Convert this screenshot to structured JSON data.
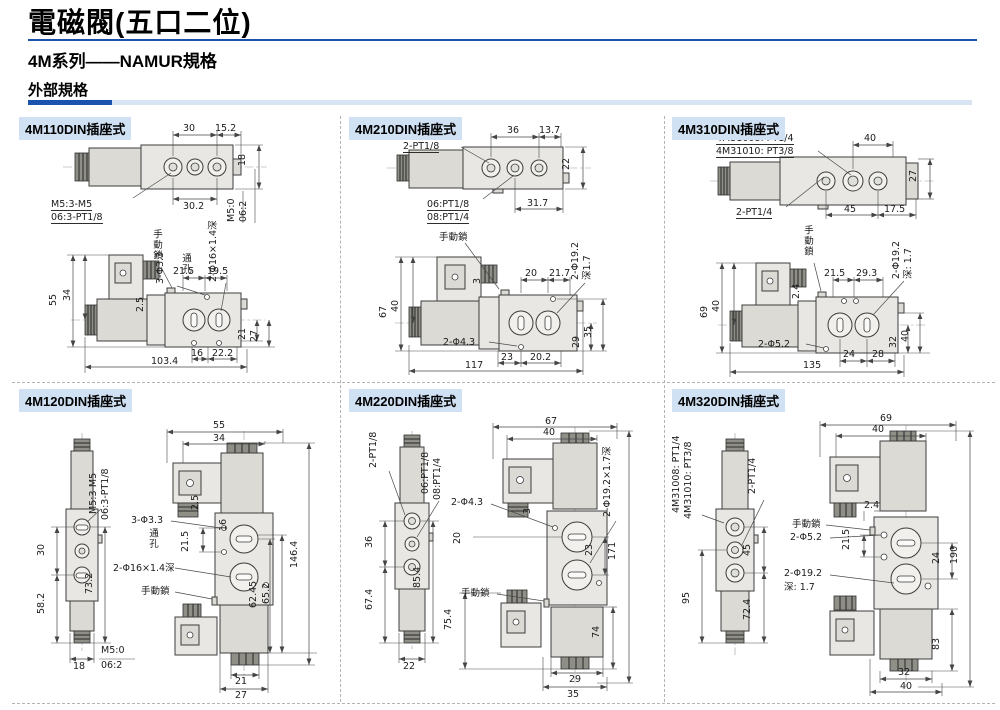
{
  "header": {
    "title": "電磁閥(五口二位)",
    "subtitle": "4M系列——NAMUR規格",
    "section": "外部規格"
  },
  "colors": {
    "accent": "#1b52ad",
    "bar_light": "#d9e4f2",
    "panel_title_bg": "#cfe1f3"
  },
  "panels": [
    {
      "title": "4M110DIN插座式",
      "d": {
        "w30": "30",
        "w152": "15.2",
        "h18": "18",
        "w302": "30.2",
        "port_m5": "M5:3-M5",
        "port_06": "06:3-PT1/8",
        "side_m5": "M5:0",
        "side_06": "06:2",
        "h55": "55",
        "h34": "34",
        "manual": "手動鎖",
        "holes": "3-Φ3.3",
        "through": "通孔",
        "cbore": "2-Φ16×1.4深",
        "w215": "21.5",
        "w195": "19.5",
        "step": "2.5",
        "h21": "21",
        "h27": "27",
        "b16": "16",
        "b222": "22.2",
        "total": "103.4"
      }
    },
    {
      "title": "4M210DIN插座式",
      "d": {
        "ports": "2-PT1/8",
        "w36": "36",
        "w137": "13.7",
        "h22": "22",
        "p06": "06:PT1/8",
        "p08": "08:PT1/4",
        "w317": "31.7",
        "manual": "手動鎖",
        "h67": "67",
        "h40": "40",
        "step": "3",
        "w20": "20",
        "w217": "21.7",
        "cbore": "2-Φ19.2",
        "cdepth": "深1.7",
        "h29": "29",
        "h35": "35",
        "holes": "2-Φ4.3",
        "b23": "23",
        "b202": "20.2",
        "total": "117"
      }
    },
    {
      "title": "4M310DIN插座式",
      "d": {
        "m08": "4M31008: PT1/4",
        "m10": "4M31010: PT3/8",
        "w40": "40",
        "h27": "27",
        "ports": "2-PT1/4",
        "b45": "45",
        "b175": "17.5",
        "manual": "手動鎖",
        "h69": "69",
        "h40": "40",
        "step": "2.4",
        "w215": "21.5",
        "w293": "29.3",
        "cbore": "2-Φ19.2",
        "cdepth": "深: 1.7",
        "h32": "32",
        "hr40": "40",
        "holes": "2-Φ5.2",
        "b24": "24",
        "b28": "28",
        "total": "135"
      }
    },
    {
      "title": "4M120DIN插座式",
      "d": {
        "port_m5": "M5:3-M5",
        "port_06": "06:3-PT1/8",
        "h30": "30",
        "h582": "58.2",
        "h732": "73.2",
        "b18": "18",
        "side_m5": "M5:0",
        "side_06": "06:2",
        "w55": "55",
        "w34": "34",
        "step": "2.5",
        "holes": "3-Φ3.3",
        "through": "通孔",
        "h215": "21.5",
        "h16": "16",
        "total": "146.4",
        "cbore": "2-Φ16×1.4深",
        "manual": "手動鎖",
        "h6245": "62.45",
        "h652": "65.2",
        "b21": "21",
        "b27": "27"
      }
    },
    {
      "title": "4M220DIN插座式",
      "d": {
        "ports": "2-PT1/8",
        "p06": "06:PT1/8",
        "p08": "08:PT1/4",
        "h36": "36",
        "h674": "67.4",
        "h854": "85.4",
        "b22": "22",
        "w67": "67",
        "w40": "40",
        "step": "3",
        "holes": "2-Φ4.3",
        "cbore": "2-Φ19.2×1.7深",
        "h20": "20",
        "h23": "23",
        "total": "171",
        "manual": "手動鎖",
        "h754": "75.4",
        "h74": "74",
        "b29": "29",
        "b35": "35"
      }
    },
    {
      "title": "4M320DIN插座式",
      "d": {
        "m08": "4M31008: PT1/4",
        "m10": "4M31010: PT3/8",
        "ports": "2-PT1/4",
        "h95": "95",
        "h45": "45",
        "h724": "72.4",
        "w69": "69",
        "w40": "40",
        "step": "2.4",
        "manual": "手動鎖",
        "holes": "2-Φ5.2",
        "h215": "21.5",
        "h24": "24",
        "total": "190",
        "cbore": "2-Φ19.2",
        "cdepth": "深: 1.7",
        "h83": "83",
        "b32": "32",
        "b40": "40"
      }
    }
  ]
}
